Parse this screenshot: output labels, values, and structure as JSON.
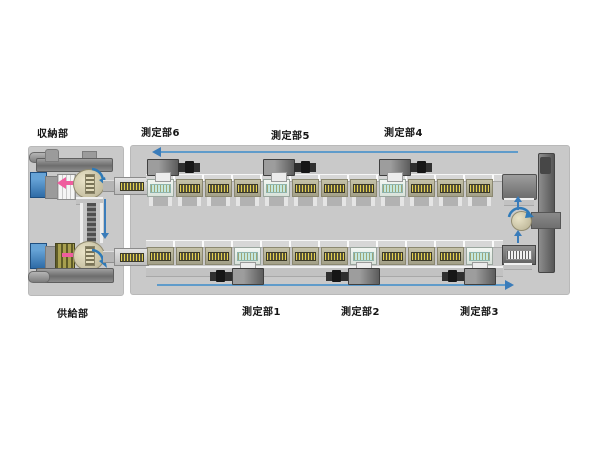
{
  "diagram": {
    "section_labels": {
      "storage": "収納部",
      "measurement6": "測定部6",
      "measurement5": "測定部5",
      "measurement4": "測定部4",
      "return_conveyor": "リターンコンベア",
      "supply": "供給部",
      "measurement1": "測定部1",
      "measurement2": "測定部2",
      "measurement3": "測定部3"
    },
    "flow": {
      "top_row_direction": "right-to-left",
      "bottom_row_direction": "left-to-right",
      "right_transfer_direction": "bottom-to-top",
      "return_conveyor_direction": "top-to-bottom"
    },
    "colors": {
      "panel_background": "#c9c9c9",
      "flow_arrow_blue": "#3a7cba",
      "transfer_arrow_pink": "#ef5d9e",
      "station_body_olive": "#b3b096",
      "station_body_active": "#e9efe9",
      "station_plate_dark": "#55523a",
      "station_plate_active": "#c2e8e1",
      "camera_body_gray": "#5c5c5c",
      "supply_box_blue": "#3577b4"
    },
    "rows": {
      "top": {
        "station_count": 12,
        "station_variants": [
          "light",
          "olive",
          "olive",
          "olive",
          "light",
          "olive",
          "olive",
          "olive",
          "light",
          "olive",
          "olive",
          "olive"
        ]
      },
      "bottom": {
        "station_count": 12,
        "station_variants": [
          "olive",
          "olive",
          "olive",
          "light",
          "olive",
          "olive",
          "olive",
          "light",
          "olive",
          "olive",
          "olive",
          "light"
        ]
      }
    }
  }
}
